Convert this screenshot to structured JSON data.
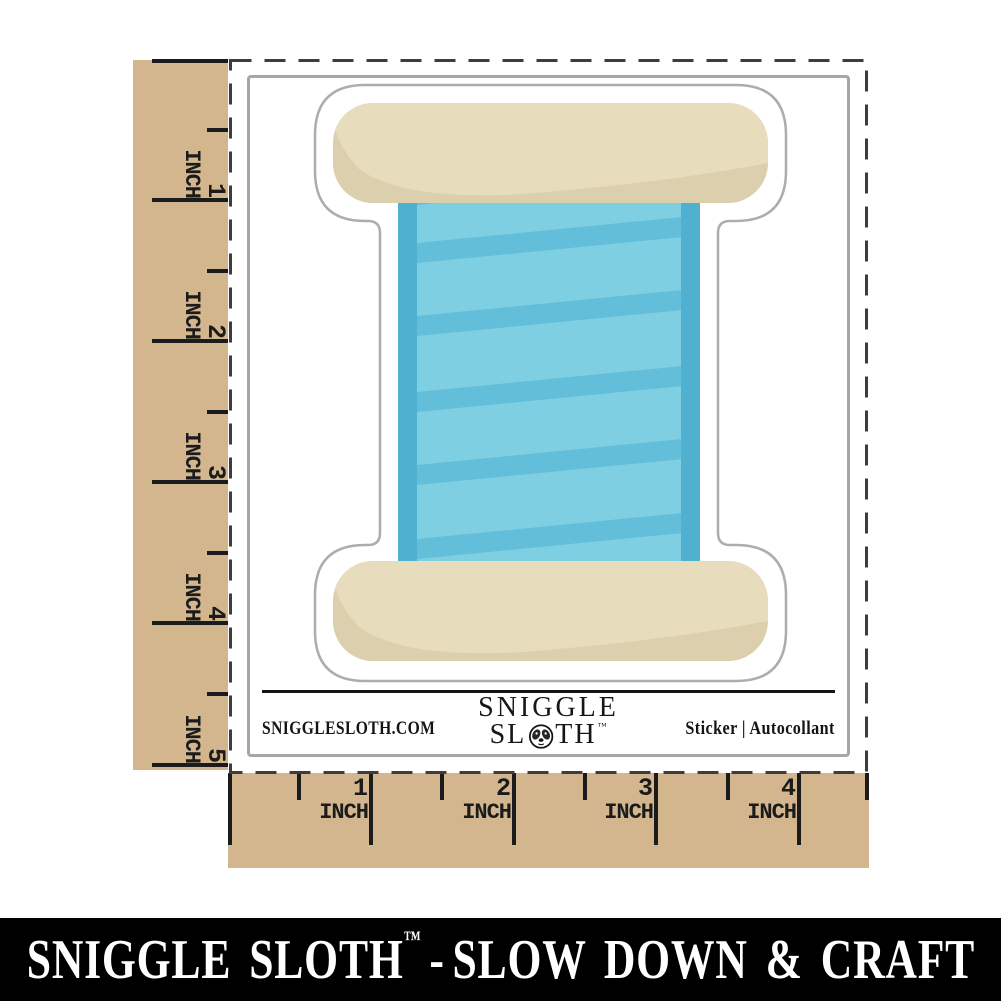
{
  "title": "Sewing Thread Spool sticker product mockup",
  "rulers": {
    "unit": "INCH",
    "left_marks": [
      "1",
      "2",
      "3",
      "4",
      "5"
    ],
    "bottom_marks": [
      "1",
      "2",
      "3",
      "4"
    ]
  },
  "sticker": {
    "design": "blue sewing thread spool with tan ends on white die-cut backing"
  },
  "branding": {
    "website": "SNIGGLESLOTH.COM",
    "logo_line1": "SNIGGLE",
    "logo_line2_pre": "SL",
    "logo_line2_post": "TH",
    "trademark": "™",
    "product_type": "Sticker | Autocollant"
  },
  "banner": {
    "brand": "SNIGGLE SLOTH",
    "trademark": "™",
    "separator": "-",
    "tagline": "SLOW DOWN & CRAFT"
  },
  "colors": {
    "ruler-tan": "#d3b68e",
    "ink": "#1b1b1b",
    "dash": "#3d3d3d",
    "card-border": "#a6a6a6",
    "sticker-outline": "#adadad",
    "cap-light": "#e7dcbc",
    "cap-shade": "#dbcfad",
    "blue-base": "#62bed9",
    "blue-edge": "#4fb0d0",
    "blue-panel": "#7ecfe2",
    "banner-bg": "#000000",
    "banner-fg": "#ffffff"
  }
}
